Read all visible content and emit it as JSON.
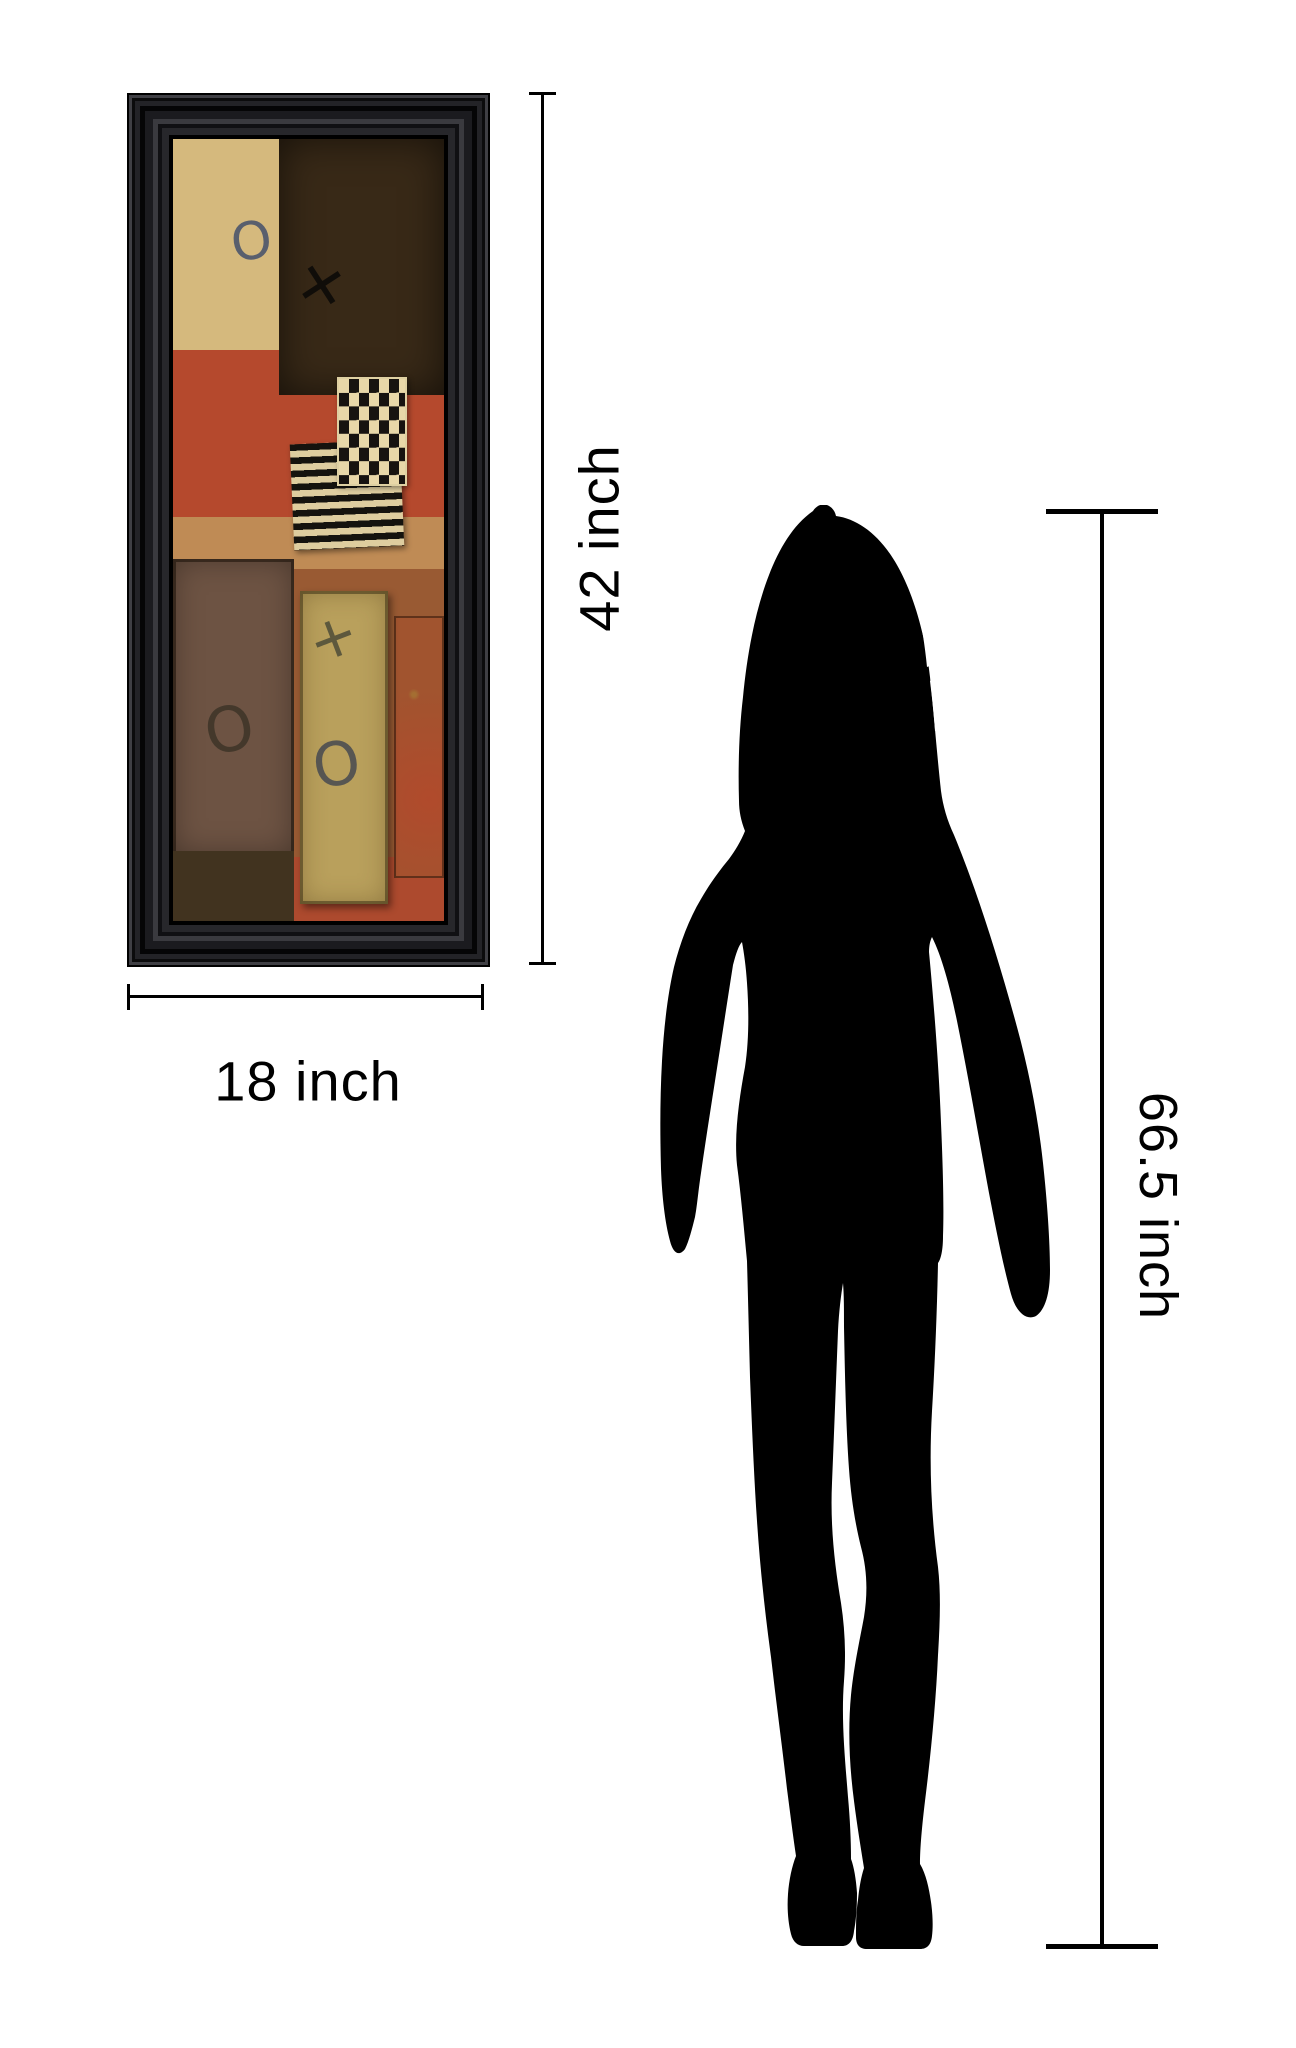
{
  "page": {
    "background": "#ffffff"
  },
  "annotations": {
    "artwork_width_label": "18 inch",
    "artwork_height_label": "42 inch",
    "person_height_label": "66.5 inch",
    "line_color": "#000000",
    "text_color": "#000000"
  },
  "artwork": {
    "frame_color": "#101013",
    "marks": {
      "top_left_o": "O",
      "top_right_x": "✕",
      "bottom_left_o": "O",
      "bottom_middle_x": "✕",
      "bottom_middle_o": "O"
    },
    "palette": {
      "cream_block": "#d5b97d",
      "dark_brown_block": "#382917",
      "red_band": "#b5492d",
      "tan_strip": "#bf8b55",
      "checker_dark": "#171310",
      "checker_light": "#e8d7a8",
      "bronze_panel": "#6d5343",
      "olive_panel": "#b9a05c",
      "rust_panel": "#a1542f",
      "bottom_red": "#ad4a2e"
    }
  },
  "silhouette": {
    "fill": "#000000",
    "figure": "standing woman"
  }
}
